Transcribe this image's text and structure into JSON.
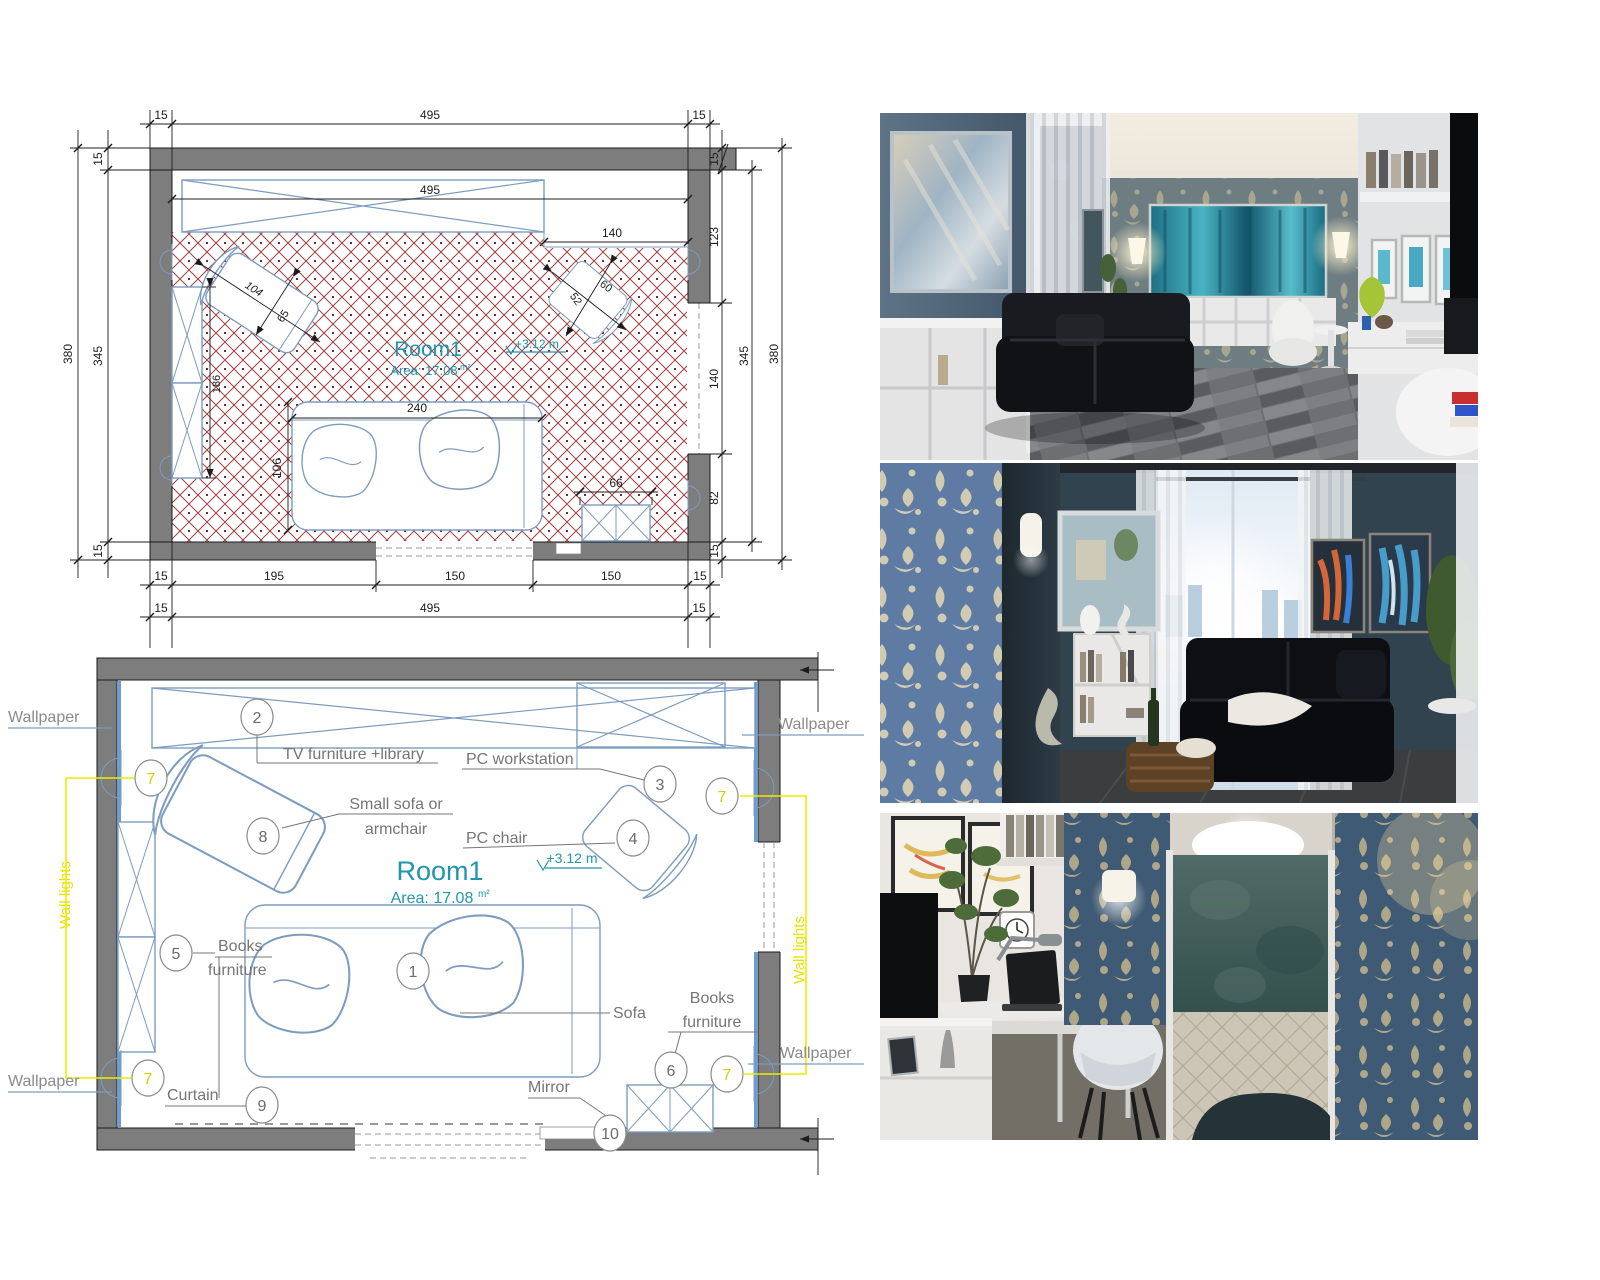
{
  "palette": {
    "wall_fill": "#7d7d7d",
    "furniture_blue": "#7c9cc0",
    "hatch_red": "#8f3a3a",
    "teal_text": "#2095ae",
    "label_grey": "#757575",
    "wall_lights_yellow": "#e8e400",
    "wallpaper_blue": "#6f9ccd"
  },
  "plan_top": {
    "room": "Room1",
    "area": "Area: 17.08",
    "area_unit": "m²",
    "level": "+3.12 m",
    "dims": {
      "wt_l": "15",
      "width": "495",
      "wt_r": "15",
      "inner_width": "495",
      "tv_gap": "140",
      "l_total": "380",
      "l_inner": "345",
      "l_wall_t": "15",
      "l_wall_b": "15",
      "r_wall_t": "15",
      "r_seg1": "123",
      "r_window": "140",
      "r_seg2": "82",
      "r_wall_b": "15",
      "r_inner": "345",
      "r_total": "380",
      "armchair_len": "104",
      "armchair_dep": "65",
      "bookcase_len": "186",
      "sofa_len": "240",
      "sofa_dep": "106",
      "chair_w": "52",
      "chair_d": "60",
      "books_len": "66",
      "b_wall_l": "15",
      "b_seg1": "195",
      "b_door": "150",
      "b_seg2": "150",
      "b_wall_r": "15",
      "b2_l": "15",
      "b2_mid": "495",
      "b2_r": "15"
    }
  },
  "plan_bottom": {
    "room": "Room1",
    "area": "Area: 17.08",
    "area_unit": "m²",
    "level": "+3.12 m",
    "labels": {
      "wallpaper": "Wallpaper",
      "wall_lights": "Wall lights",
      "tv": "TV furniture +library",
      "pc_workstation": "PC workstation",
      "pc_chair": "PC chair",
      "small_sofa_1": "Small sofa or",
      "small_sofa_2": "armchair",
      "books_1": "Books",
      "books_2": "furniture",
      "sofa": "Sofa",
      "mirror": "Mirror",
      "curtain": "Curtain"
    },
    "callouts": {
      "c1": "1",
      "c2": "2",
      "c3": "3",
      "c4": "4",
      "c5": "5",
      "c6": "6",
      "c7": "7",
      "c8": "8",
      "c9": "9",
      "c10": "10"
    }
  }
}
